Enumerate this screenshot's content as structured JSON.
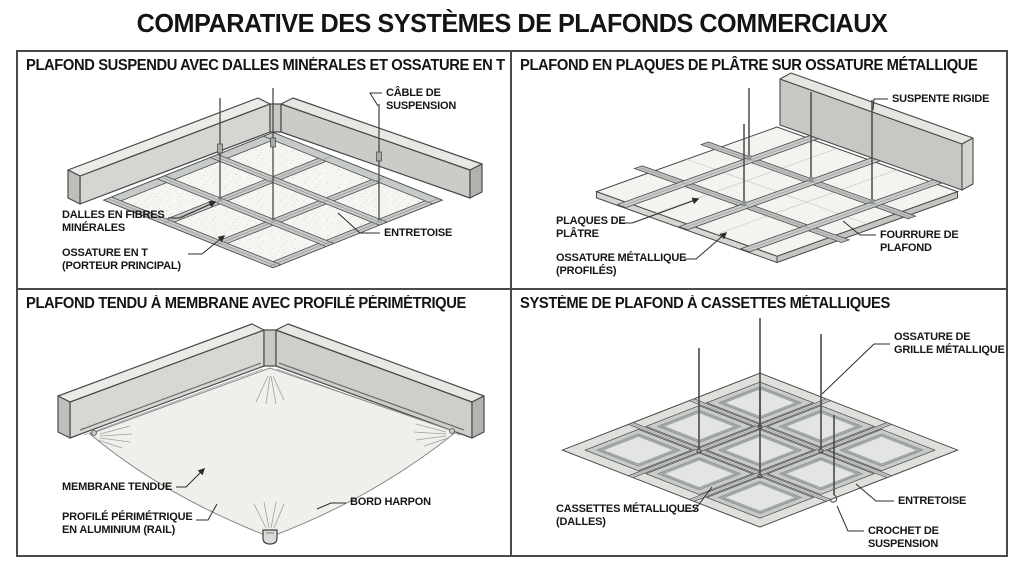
{
  "page": {
    "title": "COMPARATIVE DES SYSTÈMES DE PLAFONDS COMMERCIAUX"
  },
  "colors": {
    "ink": "#1a1a1a",
    "frame": "#4a4a4a",
    "metal_mid": "#c6cac9",
    "metal_light": "#e9e7e3",
    "tile": "#f6f5f1"
  },
  "panels": [
    {
      "id": "plafond-suspendu-dalles-minerales",
      "title": "PLAFOND SUSPENDU AVEC DALLES MINÉRALES ET OSSATURE EN T",
      "labels": {
        "cable_suspension": "CÂBLE DE SUSPENSION",
        "dalles_fibres": "DALLES EN FIBRES MINÉRALES",
        "ossature_t": "OSSATURE EN T (PORTEUR PRINCIPAL)",
        "entretoise": "ENTRETOISE"
      }
    },
    {
      "id": "plafond-plaques-platre",
      "title": "PLAFOND EN PLAQUES DE PLÂTRE SUR OSSATURE MÉTALLIQUE",
      "labels": {
        "suspente_rigide": "SUSPENTE RIGIDE",
        "plaques_platre": "PLAQUES DE PLÂTRE",
        "ossature_metallique": "OSSATURE MÉTALLIQUE (PROFILÉS)",
        "fourrure_plafond": "FOURRURE DE PLAFOND"
      }
    },
    {
      "id": "plafond-tendu-membrane",
      "title": "PLAFOND TENDU À MEMBRANE AVEC PROFILÉ PÉRIMÉTRIQUE",
      "labels": {
        "membrane_tendue": "MEMBRANE TENDUE",
        "profile_perimetrique": "PROFILÉ PÉRIMÉTRIQUE EN ALUMINIUM (RAIL)",
        "bord_harpon": "BORD HARPON"
      }
    },
    {
      "id": "plafond-cassettes-metalliques",
      "title": "SYSTÈME DE PLAFOND À CASSETTES MÉTALLIQUES",
      "labels": {
        "ossature_grille": "OSSATURE DE GRILLE MÉTALLIQUE",
        "cassettes": "CASSETTES MÉTALLIQUES (DALLES)",
        "entretoise": "ENTRETOISE",
        "crochet_suspension": "CROCHET DE SUSPENSION"
      }
    }
  ]
}
